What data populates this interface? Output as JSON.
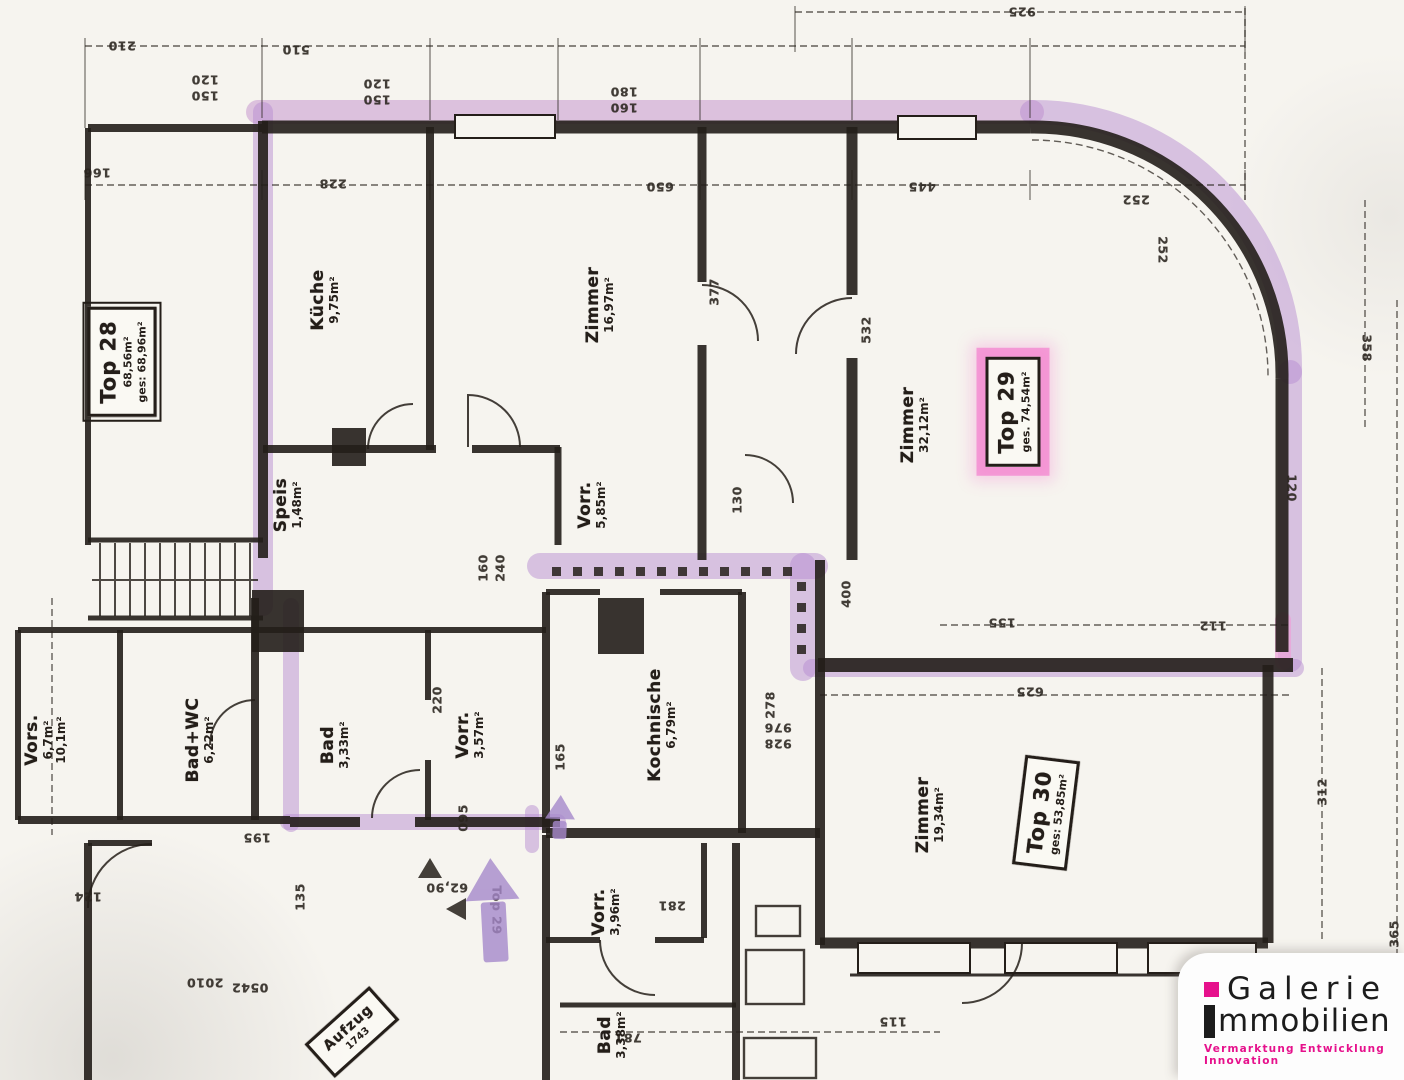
{
  "colors": {
    "ink": "#241e19",
    "paper": "#f6f4ef",
    "highlight_purple": "#b78ed1",
    "highlight_pink": "#f364c7",
    "logo_accent": "#e6118c"
  },
  "logo": {
    "brand_first": "Galerie",
    "brand_second": "mmobilien",
    "tagline": "Vermarktung  Entwicklung  Innovation"
  },
  "stamps": [
    {
      "id": "top-28",
      "x": 122,
      "y": 362,
      "rot": -90,
      "title": "Top 28",
      "lines": [
        "68,56m²",
        "ges: 68,96m²"
      ],
      "double": true,
      "hl": false,
      "small": false
    },
    {
      "id": "top-29",
      "x": 1013,
      "y": 412,
      "rot": -90,
      "title": "Top 29",
      "lines": [
        "ges. 74,54m²"
      ],
      "double": false,
      "hl": true,
      "small": false
    },
    {
      "id": "top-30",
      "x": 1046,
      "y": 813,
      "rot": -83,
      "title": "Top 30",
      "lines": [
        "ges: 53,85m²"
      ],
      "double": false,
      "hl": false,
      "small": false
    },
    {
      "id": "aufzug",
      "x": 352,
      "y": 1032,
      "rot": -42,
      "title": "Aufzug",
      "lines": [
        "1743"
      ],
      "double": false,
      "hl": false,
      "small": true
    }
  ],
  "rooms": [
    {
      "id": "kueche",
      "name": "Küche",
      "area": "9,75m²",
      "x": 325,
      "y": 300,
      "rot": -90
    },
    {
      "id": "zimmer-1",
      "name": "Zimmer",
      "area": "16,97m²",
      "x": 600,
      "y": 305,
      "rot": -90
    },
    {
      "id": "zimmer-2",
      "name": "Zimmer",
      "area": "32,12m²",
      "x": 915,
      "y": 425,
      "rot": -90
    },
    {
      "id": "vorraum-1",
      "name": "Vorr.",
      "area": "5,85m²",
      "x": 592,
      "y": 505,
      "rot": -90
    },
    {
      "id": "speis",
      "name": "Speis",
      "area": "1,48m²",
      "x": 288,
      "y": 505,
      "rot": -90
    },
    {
      "id": "vorsaal",
      "name": "Vors.",
      "area": "6,7m²",
      "extra": "10,1m²",
      "x": 46,
      "y": 740,
      "rot": -90
    },
    {
      "id": "bad-wc",
      "name": "Bad+WC",
      "area": "6,22m²",
      "x": 200,
      "y": 740,
      "rot": -90
    },
    {
      "id": "bad-1",
      "name": "Bad",
      "area": "3,33m²",
      "x": 335,
      "y": 745,
      "rot": -90
    },
    {
      "id": "vorraum-2",
      "name": "Vorr.",
      "area": "3,57m²",
      "x": 470,
      "y": 735,
      "rot": -90
    },
    {
      "id": "kochnische",
      "name": "Kochnische",
      "area": "6,79m²",
      "x": 662,
      "y": 725,
      "rot": -90
    },
    {
      "id": "zimmer-3",
      "name": "Zimmer",
      "area": "19,34m²",
      "x": 930,
      "y": 815,
      "rot": -90
    },
    {
      "id": "vorraum-3",
      "name": "Vorr.",
      "area": "3,96m²",
      "x": 606,
      "y": 912,
      "rot": -90
    },
    {
      "id": "bad-2",
      "name": "Bad",
      "area": "3,38m²",
      "x": 612,
      "y": 1035,
      "rot": -90
    }
  ],
  "plan_texts": [
    {
      "t": "925",
      "x": 1022,
      "y": 12,
      "r": 180
    },
    {
      "t": "210",
      "x": 122,
      "y": 46,
      "r": 180
    },
    {
      "t": "510",
      "x": 296,
      "y": 50,
      "r": 180
    },
    {
      "t": "120",
      "x": 205,
      "y": 80,
      "r": 180
    },
    {
      "t": "150",
      "x": 205,
      "y": 96,
      "r": 180
    },
    {
      "t": "120",
      "x": 377,
      "y": 84,
      "r": 180
    },
    {
      "t": "150",
      "x": 377,
      "y": 100,
      "r": 180
    },
    {
      "t": "180",
      "x": 624,
      "y": 92,
      "r": 180
    },
    {
      "t": "160",
      "x": 624,
      "y": 108,
      "r": 180
    },
    {
      "t": "166",
      "x": 97,
      "y": 173,
      "r": 180
    },
    {
      "t": "228",
      "x": 333,
      "y": 184,
      "r": 180
    },
    {
      "t": "650",
      "x": 660,
      "y": 187,
      "r": 180
    },
    {
      "t": "445",
      "x": 922,
      "y": 187,
      "r": 180
    },
    {
      "t": "252",
      "x": 1136,
      "y": 200,
      "r": 180
    },
    {
      "t": "252",
      "x": 1163,
      "y": 250,
      "r": 90
    },
    {
      "t": "358",
      "x": 1367,
      "y": 348,
      "r": 90
    },
    {
      "t": "120",
      "x": 1292,
      "y": 488,
      "r": 90
    },
    {
      "t": "532",
      "x": 866,
      "y": 330,
      "r": -90
    },
    {
      "t": "377",
      "x": 714,
      "y": 292,
      "r": -90
    },
    {
      "t": "130",
      "x": 737,
      "y": 500,
      "r": -90
    },
    {
      "t": "160",
      "x": 483,
      "y": 568,
      "r": -90
    },
    {
      "t": "240",
      "x": 500,
      "y": 568,
      "r": -90
    },
    {
      "t": "400",
      "x": 846,
      "y": 594,
      "r": -90
    },
    {
      "t": "155",
      "x": 1002,
      "y": 623,
      "r": 180
    },
    {
      "t": "112",
      "x": 1213,
      "y": 626,
      "r": 180
    },
    {
      "t": "625",
      "x": 1030,
      "y": 692,
      "r": 180
    },
    {
      "t": "220",
      "x": 437,
      "y": 700,
      "r": -90
    },
    {
      "t": "165",
      "x": 560,
      "y": 757,
      "r": -90
    },
    {
      "t": "278",
      "x": 770,
      "y": 705,
      "r": -90
    },
    {
      "t": "976",
      "x": 778,
      "y": 728,
      "r": 180
    },
    {
      "t": "928",
      "x": 778,
      "y": 744,
      "r": 180
    },
    {
      "t": "312",
      "x": 1322,
      "y": 792,
      "r": -90
    },
    {
      "t": "365",
      "x": 1394,
      "y": 934,
      "r": -90
    },
    {
      "t": "195",
      "x": 257,
      "y": 838,
      "r": 180
    },
    {
      "t": "095",
      "x": 463,
      "y": 818,
      "r": -90
    },
    {
      "t": "135",
      "x": 300,
      "y": 897,
      "r": -90
    },
    {
      "t": "124",
      "x": 88,
      "y": 897,
      "r": 180
    },
    {
      "t": "62,90",
      "x": 447,
      "y": 888,
      "r": 180
    },
    {
      "t": "Top 29",
      "x": 497,
      "y": 910,
      "r": 90
    },
    {
      "t": "281",
      "x": 672,
      "y": 906,
      "r": 180
    },
    {
      "t": "2010",
      "x": 205,
      "y": 983,
      "r": 180
    },
    {
      "t": "0542",
      "x": 250,
      "y": 988,
      "r": 180
    },
    {
      "t": "115",
      "x": 893,
      "y": 1022,
      "r": 180
    },
    {
      "t": "781",
      "x": 628,
      "y": 1038,
      "r": 180
    }
  ]
}
